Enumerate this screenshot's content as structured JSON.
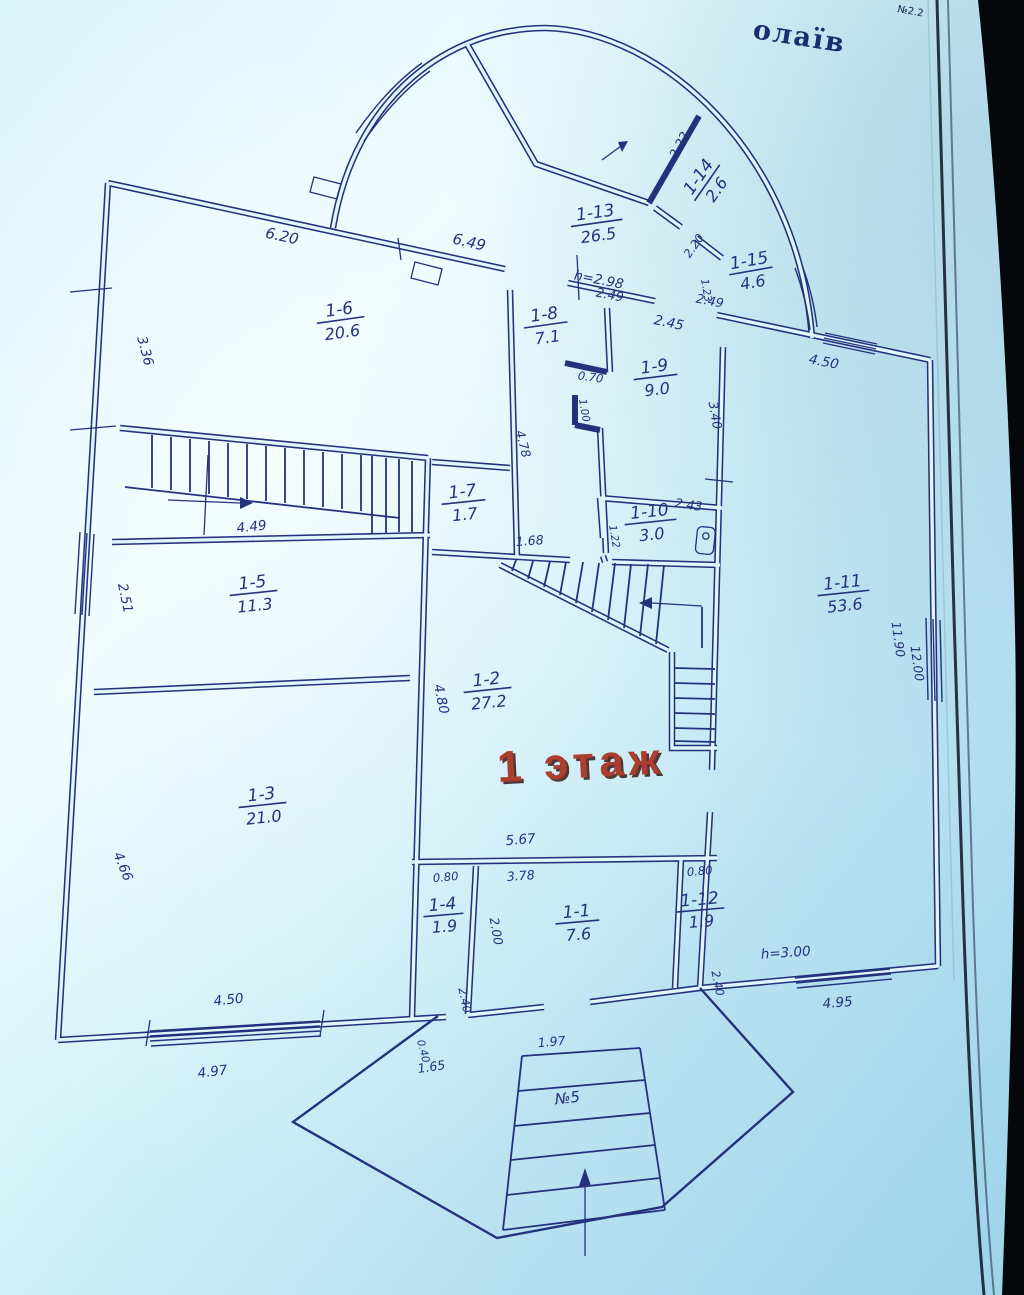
{
  "photo": {
    "header_fragment": "олаїв",
    "corner_note": "№2.2"
  },
  "plan": {
    "floor_label": "1 этаж",
    "entry_label": "№5",
    "height_bay": "h=2.98",
    "height_terrace": "h=3.00",
    "rooms": [
      {
        "id": "1-1",
        "area": "7.6"
      },
      {
        "id": "1-2",
        "area": "27.2"
      },
      {
        "id": "1-3",
        "area": "21.0"
      },
      {
        "id": "1-4",
        "area": "1.9"
      },
      {
        "id": "1-5",
        "area": "11.3"
      },
      {
        "id": "1-6",
        "area": "20.6"
      },
      {
        "id": "1-7",
        "area": "1.7"
      },
      {
        "id": "1-8",
        "area": "7.1"
      },
      {
        "id": "1-9",
        "area": "9.0"
      },
      {
        "id": "1-10",
        "area": "3.0"
      },
      {
        "id": "1-11",
        "area": "53.6"
      },
      {
        "id": "1-12",
        "area": "1.9"
      },
      {
        "id": "1-13",
        "area": "26.5"
      },
      {
        "id": "1-14",
        "area": "2.6"
      },
      {
        "id": "1-15",
        "area": "4.6"
      }
    ],
    "dims": {
      "top_1_6": "6.20",
      "top_bay": "6.49",
      "left_1_6": "3.36",
      "left_1_5": "2.51",
      "left_1_3": "4.66",
      "corridor_width": "4.49",
      "win_1_3": "4.50",
      "win_1_3_outer": "4.97",
      "top_1_9": "2.45",
      "bay_opening": "2.49",
      "bay_wall_1_14": "2.22",
      "bay_door_1_15": "2.20",
      "bay_side_1_15": "1.23",
      "top_1_11": "4.50",
      "jog_width": "0.70",
      "jog_height": "1.00",
      "wall_1_8": "4.78",
      "opening_1_7": "1.68",
      "side_1_10": "1.22",
      "top_1_10": "2.43",
      "side_1_9": "3.40",
      "right_upper": "11.90",
      "right_lower": "12.00",
      "left_1_2": "4.80",
      "bottom_1_2": "5.67",
      "top_1_4": "0.80",
      "top_1_12": "0.80",
      "top_1_1": "3.78",
      "side_1_1": "2.00",
      "side_1_4": "2.40",
      "side_1_12": "2.40",
      "door_1_1": "1.97",
      "porch_left": "1.65",
      "wall_small": "0.40",
      "terrace_window": "4.95"
    }
  },
  "colors": {
    "ink": "#25317c",
    "paper_light": "#e9fcff",
    "paper_shade": "#9cd2e8",
    "red_text": "#ad3d2e",
    "photo_black": "#05070a"
  }
}
